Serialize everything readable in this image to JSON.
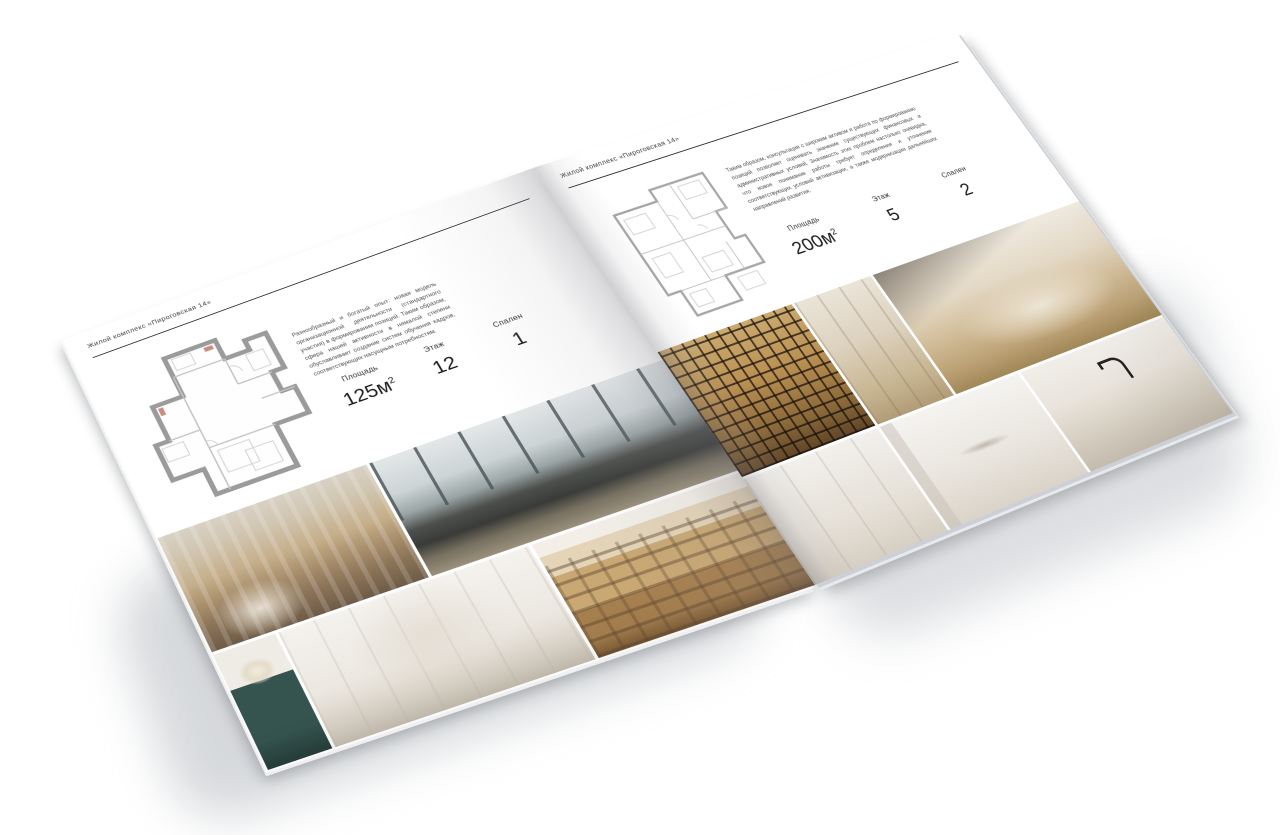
{
  "brochure": {
    "title": "Жилой комплекс «Пироговская 14»",
    "colors": {
      "paper": "#ffffff",
      "ink": "#2b2b2b",
      "rule": "#2e2e2e",
      "plan_walls": "#9b9b9b"
    },
    "left_page": {
      "header": "Жилой комплекс «Пироговская 14»",
      "description": "Разнообразный и богатый опыт: новая модель организационной деятельности (стандартного участия) в формировании позиций. Таким образом, сфера нашей активности в немалой степени обуславливает создание систем обучения кадров, соответствующих насущным потребностям.",
      "stats": [
        {
          "label": "Площадь",
          "value": "125м",
          "sup": "2"
        },
        {
          "label": "Этаж",
          "value": "12",
          "sup": ""
        },
        {
          "label": "Спален",
          "value": "1",
          "sup": ""
        }
      ],
      "floor_plan": "план квартиры 125 м²",
      "photos": [
        "спальня с декоративными подушками",
        "гостиная с панорамными окнами и тёмной кроватью",
        "консоль с цветами",
        "белая спальня с нишами",
        "коридор с книжными стеллажами"
      ]
    },
    "right_page": {
      "header": "Жилой комплекс «Пироговская 14»",
      "description": "Таким образом, консультация с широким активом и работа по формированию позиций позволяет оценивать значение существующих финансовых и административных условий. Значимость этих проблем настолько очевидна, что новое понимание работы требует определения и уточнения соответствующих условий активизации, а также модернизации дальнейших направлений развития.",
      "stats": [
        {
          "label": "Площадь",
          "value": "200м",
          "sup": "2"
        },
        {
          "label": "Этаж",
          "value": "5",
          "sup": ""
        },
        {
          "label": "Спален",
          "value": "2",
          "sup": ""
        }
      ],
      "floor_plan": "план квартиры 200 м²",
      "photos": [
        "гардеробная с подсветкой",
        "гардеробная из светлого дерева",
        "гостиная с кушеткой и торшером",
        "светлый холл",
        "ванная комната с полотенцем",
        "кухня с чёрным смесителем"
      ]
    }
  }
}
